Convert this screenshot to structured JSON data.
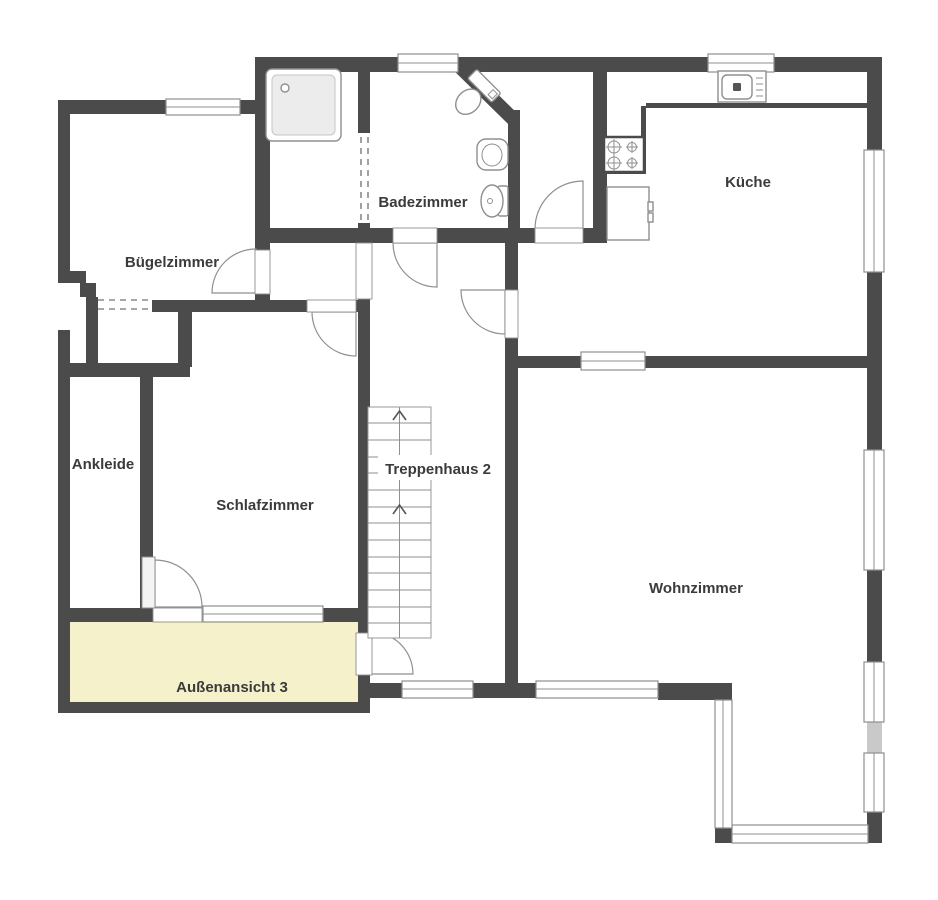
{
  "rooms": [
    {
      "label": "Bügelzimmer"
    },
    {
      "label": "Badezimmer"
    },
    {
      "label": "Küche"
    },
    {
      "label": "Ankleide"
    },
    {
      "label": "Schlafzimmer"
    },
    {
      "label": "Treppenhaus 2"
    },
    {
      "label": "Wohnzimmer"
    },
    {
      "label": "Außenansicht 3"
    }
  ],
  "fixtures": [
    {
      "name": "shower-icon"
    },
    {
      "name": "toilet-icon"
    },
    {
      "name": "washbasin-icon"
    },
    {
      "name": "bidet-icon"
    },
    {
      "name": "kitchen-sink-icon"
    },
    {
      "name": "stove-icon"
    },
    {
      "name": "refrigerator-icon"
    },
    {
      "name": "stairs-up-icon"
    }
  ],
  "colors": {
    "wall": "#4b4b4b",
    "line": "#8f8f8f",
    "fixture": "#8f8f8f",
    "label": "#3b3b3b",
    "terrace": "#f5f1ca",
    "shower": "#ececec",
    "grayseg": "#c9c9c9",
    "dash": "#8a8a8a"
  }
}
